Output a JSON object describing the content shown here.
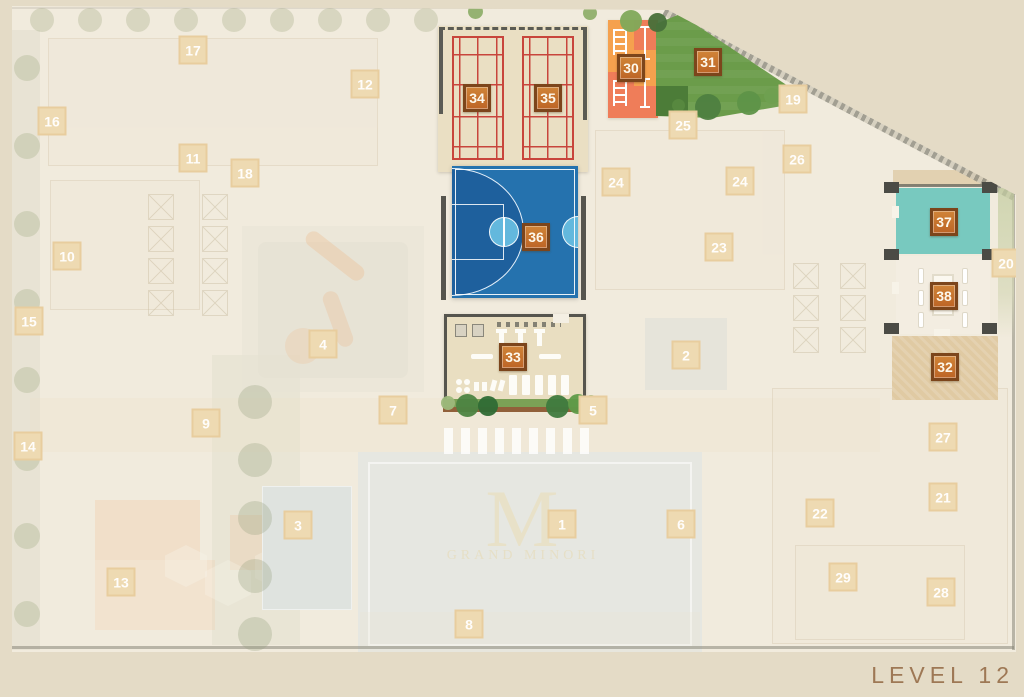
{
  "level_label": "LEVEL 12",
  "watermark": {
    "initial": "M",
    "name": "GRAND MINORI"
  },
  "colors": {
    "marker_active_bg": "#C9772F",
    "marker_active_border": "#7C451B",
    "marker_faded_bg": "#EEDAB2",
    "basketball_court": "#2572AE",
    "basketball_paint": "#1E609D",
    "basketball_circle": "#63B8DD",
    "badminton_lines": "#C8453C",
    "badminton_floor": "#EADFC3",
    "lawn_green": "#6B9C4A",
    "playground_orange": "#F5A14E",
    "playground_salmon": "#EF7D59",
    "room_37_teal": "#78C9BF",
    "room_38_cream": "#F3EDE1",
    "deck_32_tan": "#E0CAA3",
    "gym_floor": "#E9DEC1",
    "map_base": "#F1EBDD",
    "page_background": "#E4DBC6",
    "level_text": "#9E7855"
  },
  "markers": [
    {
      "number": "30",
      "x": 631,
      "y": 68,
      "state": "active",
      "kind": "playground"
    },
    {
      "number": "31",
      "x": 708,
      "y": 62,
      "state": "active",
      "kind": "lawn"
    },
    {
      "number": "32",
      "x": 945,
      "y": 367,
      "state": "active",
      "kind": "deck"
    },
    {
      "number": "33",
      "x": 513,
      "y": 357,
      "state": "active",
      "kind": "gym"
    },
    {
      "number": "34",
      "x": 477,
      "y": 98,
      "state": "active",
      "kind": "badminton-court"
    },
    {
      "number": "35",
      "x": 548,
      "y": 98,
      "state": "active",
      "kind": "badminton-court"
    },
    {
      "number": "36",
      "x": 536,
      "y": 237,
      "state": "active",
      "kind": "basketball-court"
    },
    {
      "number": "37",
      "x": 944,
      "y": 222,
      "state": "active",
      "kind": "room"
    },
    {
      "number": "38",
      "x": 944,
      "y": 296,
      "state": "active",
      "kind": "room"
    },
    {
      "number": "1",
      "x": 562,
      "y": 524,
      "state": "faded"
    },
    {
      "number": "2",
      "x": 686,
      "y": 355,
      "state": "faded"
    },
    {
      "number": "3",
      "x": 298,
      "y": 525,
      "state": "faded"
    },
    {
      "number": "4",
      "x": 323,
      "y": 344,
      "state": "faded"
    },
    {
      "number": "5",
      "x": 593,
      "y": 410,
      "state": "faded"
    },
    {
      "number": "6",
      "x": 681,
      "y": 524,
      "state": "faded"
    },
    {
      "number": "7",
      "x": 393,
      "y": 410,
      "state": "faded"
    },
    {
      "number": "8",
      "x": 469,
      "y": 624,
      "state": "faded"
    },
    {
      "number": "9",
      "x": 206,
      "y": 423,
      "state": "faded"
    },
    {
      "number": "10",
      "x": 67,
      "y": 256,
      "state": "faded"
    },
    {
      "number": "11",
      "x": 193,
      "y": 158,
      "state": "faded"
    },
    {
      "number": "12",
      "x": 365,
      "y": 84,
      "state": "faded"
    },
    {
      "number": "13",
      "x": 121,
      "y": 582,
      "state": "faded"
    },
    {
      "number": "14",
      "x": 28,
      "y": 446,
      "state": "faded"
    },
    {
      "number": "15",
      "x": 29,
      "y": 321,
      "state": "faded"
    },
    {
      "number": "16",
      "x": 52,
      "y": 121,
      "state": "faded"
    },
    {
      "number": "17",
      "x": 193,
      "y": 50,
      "state": "faded"
    },
    {
      "number": "18",
      "x": 245,
      "y": 173,
      "state": "faded"
    },
    {
      "number": "19",
      "x": 793,
      "y": 99,
      "state": "faded"
    },
    {
      "number": "20",
      "x": 1006,
      "y": 263,
      "state": "faded"
    },
    {
      "number": "21",
      "x": 943,
      "y": 497,
      "state": "faded"
    },
    {
      "number": "22",
      "x": 820,
      "y": 513,
      "state": "faded"
    },
    {
      "number": "23",
      "x": 719,
      "y": 247,
      "state": "faded"
    },
    {
      "number": "24",
      "x": 616,
      "y": 182,
      "state": "faded"
    },
    {
      "number": "24",
      "x": 740,
      "y": 181,
      "state": "faded"
    },
    {
      "number": "25",
      "x": 683,
      "y": 125,
      "state": "faded"
    },
    {
      "number": "26",
      "x": 797,
      "y": 159,
      "state": "faded"
    },
    {
      "number": "27",
      "x": 943,
      "y": 437,
      "state": "faded"
    },
    {
      "number": "28",
      "x": 941,
      "y": 592,
      "state": "faded"
    },
    {
      "number": "29",
      "x": 843,
      "y": 577,
      "state": "faded"
    }
  ]
}
